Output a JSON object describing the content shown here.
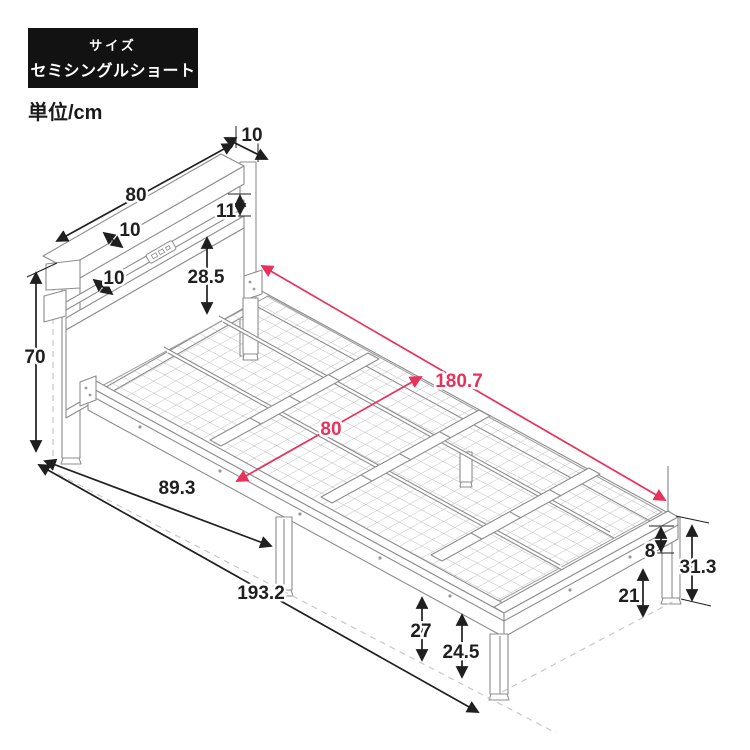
{
  "header": {
    "size_caption": "サイズ",
    "size_value": "セミシングルショート",
    "unit_label": "単位/cm",
    "badge_bg": "#121212",
    "badge_text_color": "#ffffff"
  },
  "colors": {
    "dimension_line": "#1f1f1f",
    "accent_red": "#e7325c",
    "bed_outline": "#8d8d8d",
    "mesh_line": "#b3b3b3",
    "dashed_guide": "#c9c9c9",
    "background": "#ffffff"
  },
  "dimensions": {
    "headboard_top_depth": "10",
    "headboard_width": "80",
    "mid_shelf_depth": "10",
    "slot_height": "11",
    "lower_shelf_depth": "10",
    "panel_height": "28.5",
    "headboard_height": "70",
    "inner_length": "180.7",
    "inner_width": "80",
    "under_bed_length": "89.3",
    "total_length": "193.2",
    "frame_height": "8",
    "floor_to_frame_top": "31.3",
    "under_clearance": "21",
    "floor_to_rail": "27",
    "floor_to_frame_bottom": "24.5"
  }
}
